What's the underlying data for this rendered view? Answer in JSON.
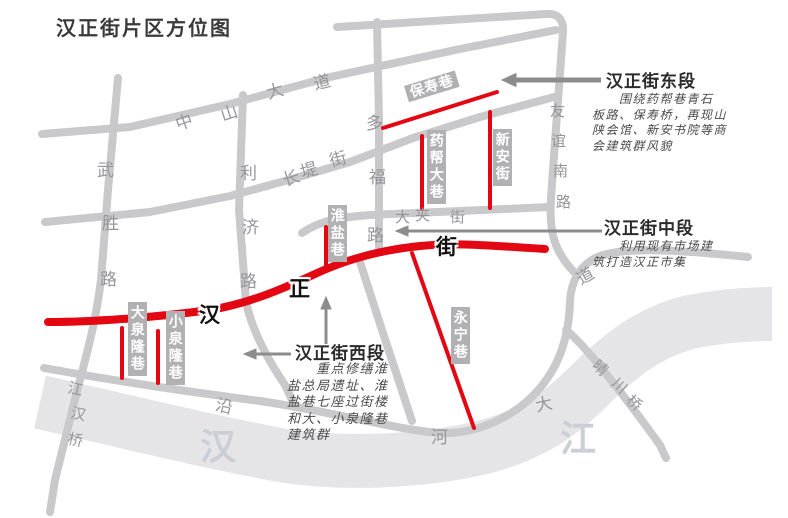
{
  "title": "汉正街片区方位图",
  "colors": {
    "highlight_red": "#e30613",
    "road_gray": "#c9c9cb",
    "river_gray": "#e5e5e8",
    "label_bg": "#b1b1b4",
    "arrow_gray": "#8c8c8e"
  },
  "main_street": {
    "name": "汉正街"
  },
  "river": {
    "name": "汉江"
  },
  "road_labels": [
    {
      "id": "zhongshan-avenue",
      "name": "中山大道",
      "cls": "road",
      "chars": [
        {
          "t": "中",
          "x": 175,
          "y": 108,
          "r": -20
        },
        {
          "t": "山",
          "x": 220,
          "y": 99,
          "r": -18
        },
        {
          "t": "大",
          "x": 266,
          "y": 77,
          "r": -16
        },
        {
          "t": "道",
          "x": 313,
          "y": 68,
          "r": -14
        }
      ]
    },
    {
      "id": "changdi-street",
      "name": "长堤街",
      "cls": "road",
      "chars": [
        {
          "t": "长",
          "x": 282,
          "y": 164,
          "r": -18
        },
        {
          "t": "堤",
          "x": 300,
          "y": 156,
          "r": -16
        },
        {
          "t": "街",
          "x": 329,
          "y": 145,
          "r": -15
        }
      ]
    },
    {
      "id": "wusheng-road",
      "name": "武胜路",
      "cls": "road",
      "chars": [
        {
          "t": "武",
          "x": 97,
          "y": 156,
          "r": 0
        },
        {
          "t": "胜",
          "x": 102,
          "y": 209,
          "r": 0
        },
        {
          "t": "路",
          "x": 100,
          "y": 265,
          "r": 0
        }
      ]
    },
    {
      "id": "liji-road",
      "name": "利济路",
      "cls": "road",
      "chars": [
        {
          "t": "利",
          "x": 240,
          "y": 159,
          "r": 0
        },
        {
          "t": "济",
          "x": 242,
          "y": 213,
          "r": 0
        },
        {
          "t": "路",
          "x": 240,
          "y": 267,
          "r": 0
        }
      ]
    },
    {
      "id": "duofu-road",
      "name": "多福路",
      "cls": "road",
      "chars": [
        {
          "t": "多",
          "x": 366,
          "y": 109,
          "r": 0
        },
        {
          "t": "福",
          "x": 369,
          "y": 163,
          "r": 0
        },
        {
          "t": "路",
          "x": 367,
          "y": 221,
          "r": 0
        }
      ]
    },
    {
      "id": "dajia-street",
      "name": "大夹街",
      "cls": "road-sm",
      "chars": [
        {
          "t": "大",
          "x": 395,
          "y": 206,
          "r": 0
        },
        {
          "t": "夹",
          "x": 415,
          "y": 204,
          "r": 0
        },
        {
          "t": "街",
          "x": 450,
          "y": 206,
          "r": 0
        }
      ]
    },
    {
      "id": "youyi-south-road",
      "name": "友谊南路",
      "cls": "road-sm",
      "chars": [
        {
          "t": "友",
          "x": 550,
          "y": 100,
          "r": 0
        },
        {
          "t": "谊",
          "x": 551,
          "y": 130,
          "r": 0
        },
        {
          "t": "南",
          "x": 553,
          "y": 160,
          "r": 0
        },
        {
          "t": "路",
          "x": 556,
          "y": 191,
          "r": 0
        }
      ]
    },
    {
      "id": "yanhe-avenue",
      "name": "沿河大道",
      "cls": "road",
      "chars": [
        {
          "t": "沿",
          "x": 216,
          "y": 392,
          "r": 14
        },
        {
          "t": "河",
          "x": 431,
          "y": 423,
          "r": 0
        },
        {
          "t": "大",
          "x": 535,
          "y": 390,
          "r": -12
        },
        {
          "t": "道",
          "x": 576,
          "y": 262,
          "r": -30
        }
      ]
    },
    {
      "id": "jianghan-bridge",
      "name": "江汉桥",
      "cls": "road-sm",
      "chars": [
        {
          "t": "江",
          "x": 68,
          "y": 378,
          "r": 12
        },
        {
          "t": "汉",
          "x": 71,
          "y": 403,
          "r": 12
        },
        {
          "t": "桥",
          "x": 68,
          "y": 429,
          "r": 12
        }
      ]
    },
    {
      "id": "qingchuan-bridge",
      "name": "晴川桥",
      "cls": "road-sm",
      "chars": [
        {
          "t": "晴",
          "x": 593,
          "y": 357,
          "r": 42
        },
        {
          "t": "川",
          "x": 612,
          "y": 375,
          "r": 42
        },
        {
          "t": "桥",
          "x": 627,
          "y": 392,
          "r": 42
        }
      ]
    },
    {
      "id": "hanzheng-street-name",
      "name": "汉正街",
      "cls": "street",
      "chars": [
        {
          "t": "汉",
          "x": 199,
          "y": 299,
          "r": 0
        },
        {
          "t": "正",
          "x": 289,
          "y": 273,
          "r": 0
        },
        {
          "t": "街",
          "x": 436,
          "y": 231,
          "r": 0
        }
      ]
    },
    {
      "id": "han-river-name",
      "name": "汉江",
      "cls": "river",
      "chars": [
        {
          "t": "汉",
          "x": 200,
          "y": 418,
          "r": 0
        },
        {
          "t": "江",
          "x": 560,
          "y": 410,
          "r": 0
        }
      ]
    }
  ],
  "alley_labels": [
    {
      "id": "baoshou-alley",
      "name": "保寿巷",
      "x": 404,
      "y": 86,
      "r": -17,
      "h": true
    },
    {
      "id": "yaobang-alley",
      "name": "药帮大巷",
      "x": 427,
      "y": 130,
      "r": 0,
      "h": false
    },
    {
      "id": "xinan-street",
      "name": "新安街",
      "x": 493,
      "y": 129,
      "r": 0,
      "h": false
    },
    {
      "id": "huaiyan-alley",
      "name": "淮盐巷",
      "x": 328,
      "y": 205,
      "r": 0,
      "h": false
    },
    {
      "id": "yongning-alley",
      "name": "永宁巷",
      "x": 451,
      "y": 307,
      "r": 0,
      "h": false
    },
    {
      "id": "daquanlong-alley",
      "name": "大泉隆巷",
      "x": 128,
      "y": 302,
      "r": 0,
      "h": false
    },
    {
      "id": "xiaoquanlong-alley",
      "name": "小泉隆巷",
      "x": 166,
      "y": 311,
      "r": 0,
      "h": false
    }
  ],
  "annotations": {
    "east": {
      "heading": "汉正街东段",
      "body": "　　围绕药帮巷青石\n板路、保寿桥，再现山\n陕会馆、新安书院等商\n会建筑群风貌"
    },
    "mid": {
      "heading": "汉正街中段",
      "body": "　　利用现有市场建\n筑打造汉正市集"
    },
    "west": {
      "heading": "汉正街西段",
      "body": "　　重点修缮淮\n盐总局遗址、淮\n盐巷七座过街楼\n和大、小泉隆巷\n建筑群"
    }
  }
}
